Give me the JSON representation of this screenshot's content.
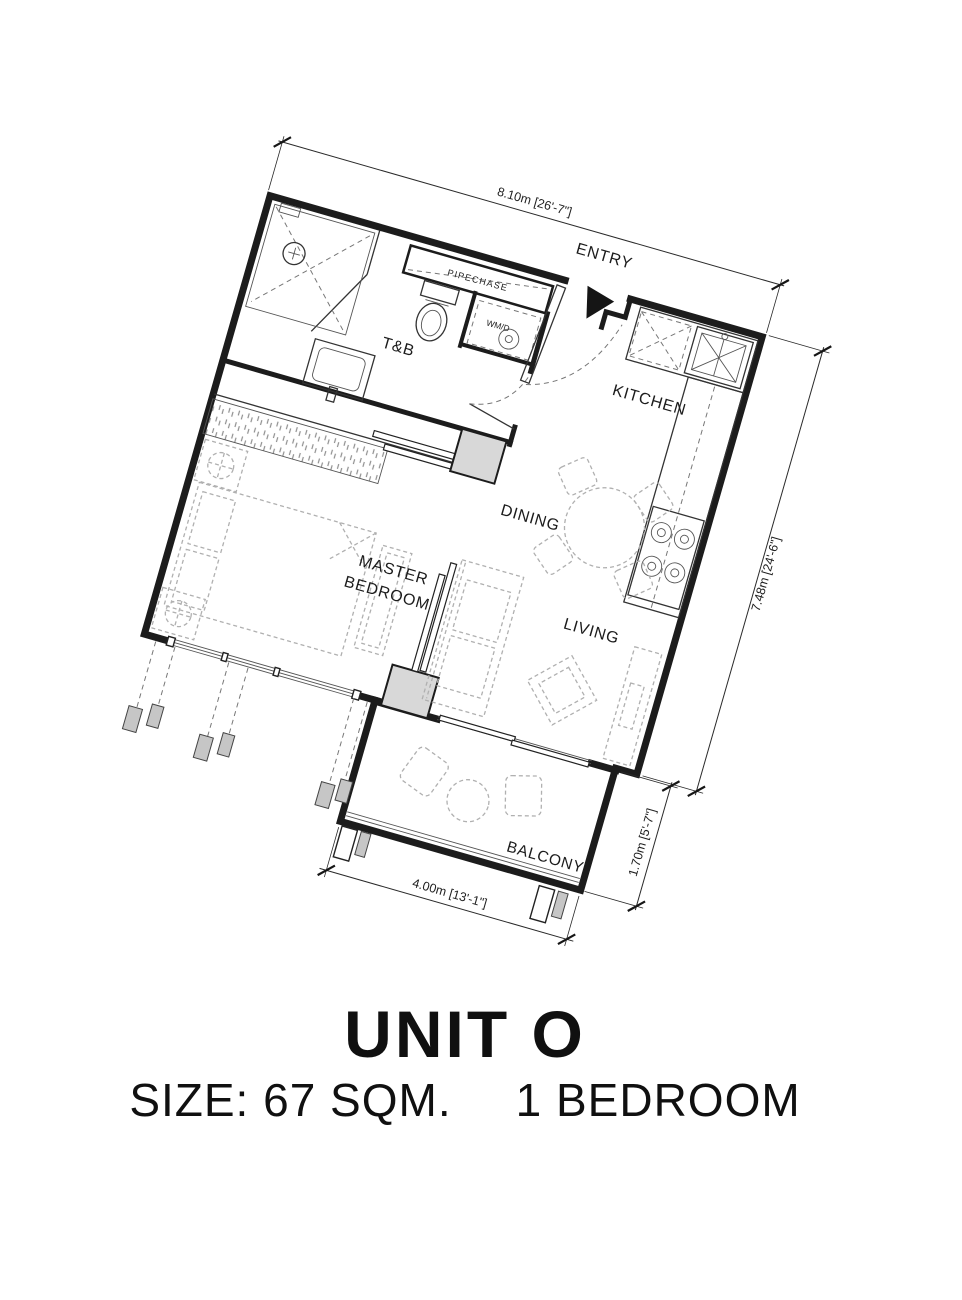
{
  "plan": {
    "rotation_deg": 16,
    "line_color": "#1c1c1c",
    "furniture_color": "#b0b0b0",
    "labels": {
      "entry": "ENTRY",
      "tb": "T&B",
      "pipechase": "PIPECHASE",
      "wmd": "WM/D",
      "kitchen": "KITCHEN",
      "dining": "DINING",
      "living": "LIVING",
      "master_line1": "MASTER",
      "master_line2": "BEDROOM",
      "balcony": "BALCONY"
    },
    "dimensions": {
      "top": "8.10m [26'-7\"]",
      "right": "7.48m [24'-6\"]",
      "balcony_width": "4.00m [13'-1\"]",
      "balcony_depth": "1.70m [5'-7\"]"
    }
  },
  "title": {
    "unit": "UNIT O",
    "size": "SIZE: 67 SQM.",
    "bedrooms": "1 BEDROOM"
  }
}
